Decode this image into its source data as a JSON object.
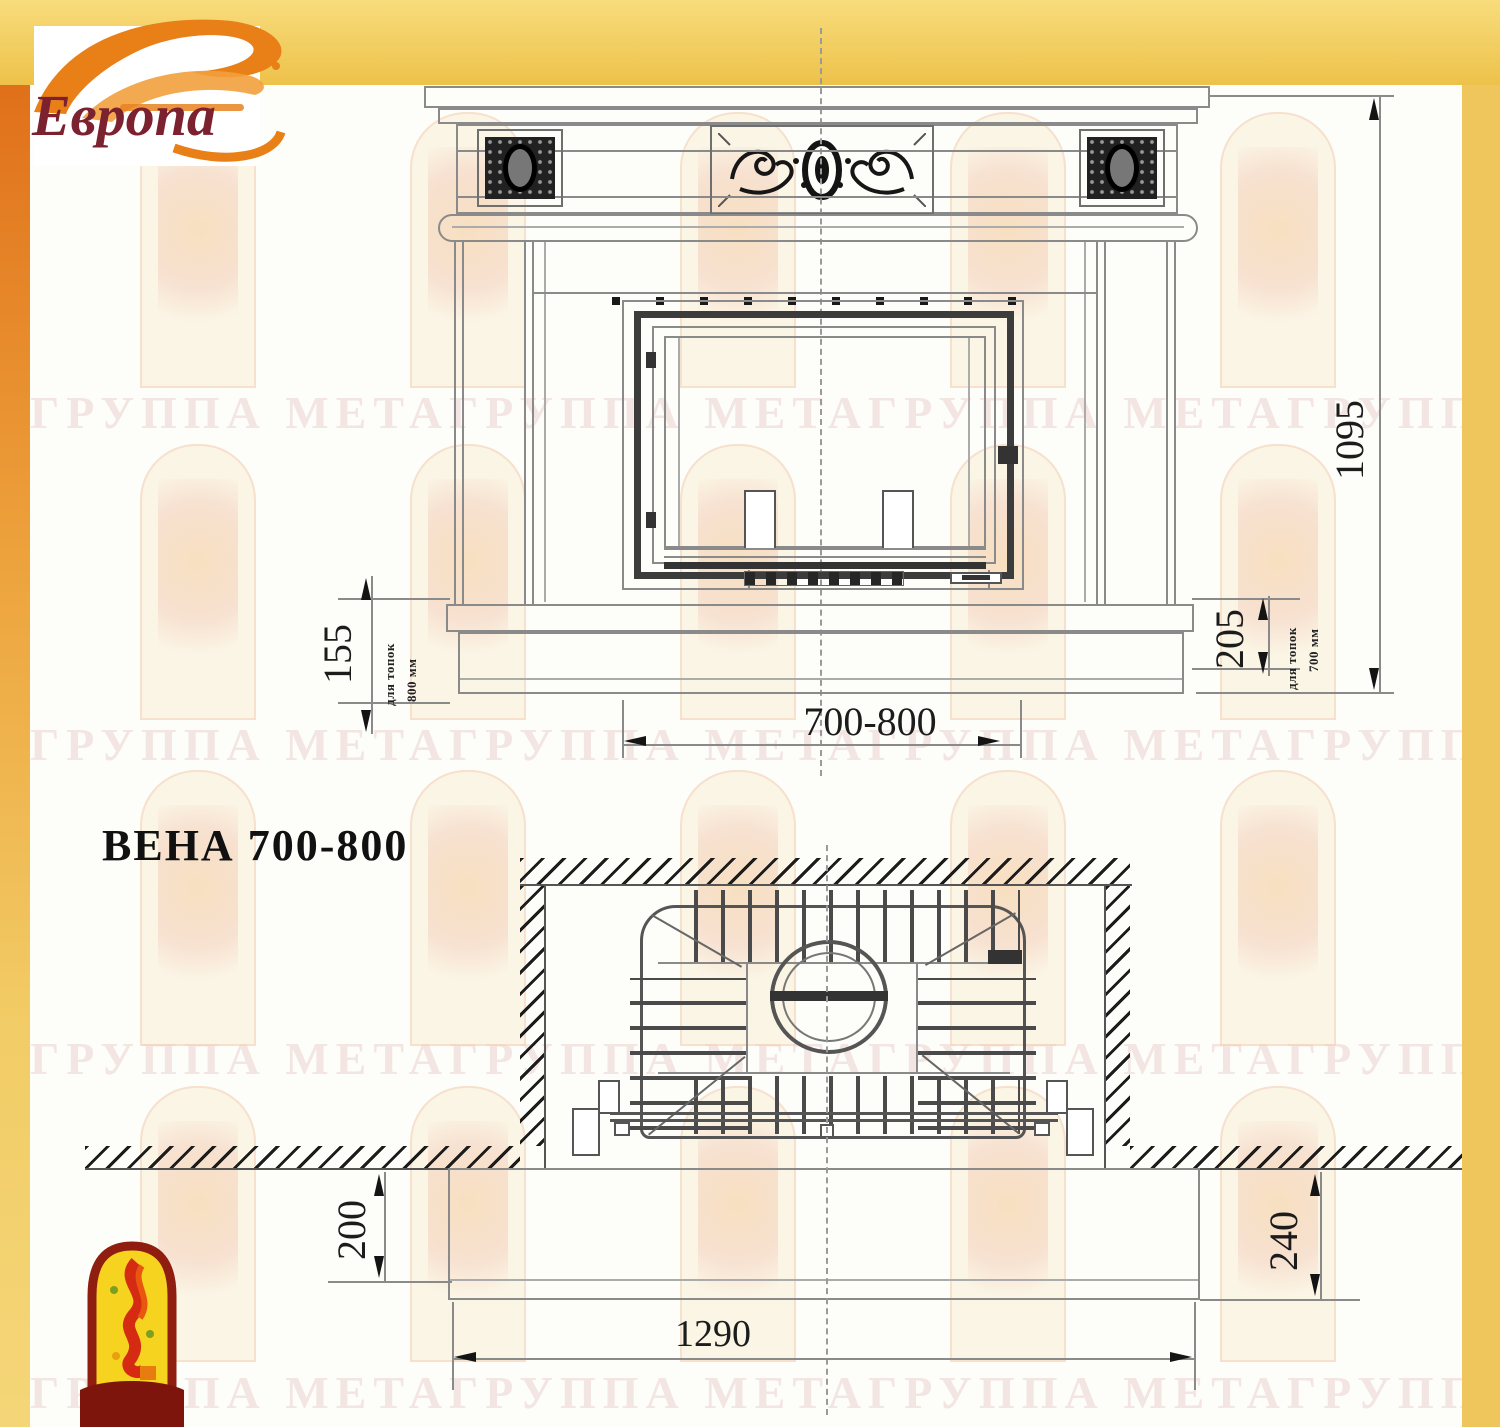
{
  "brand": {
    "logo_text": "Европа"
  },
  "title": "ВЕНА 700-800",
  "watermark_text": "ГРУППА МЕТАГРУППА МЕТАГРУППА МЕТАГРУППА МЕТАГРУППА МЕТА",
  "front_view": {
    "overall_height": "1095",
    "firebox_width_range": "700-800",
    "hearth_height_left": "155",
    "hearth_left_note_line1": "для топок",
    "hearth_left_note_line2": "800 мм",
    "hearth_height_right": "205",
    "hearth_right_note_line1": "для топок",
    "hearth_right_note_line2": "700 мм"
  },
  "plan_view": {
    "wall_offset_left": "200",
    "wall_offset_right": "240",
    "hearth_width": "1290"
  },
  "colors": {
    "frame_yellow": "#efc65c",
    "frame_orange": "#e0701a",
    "line_gray": "#8a8a8a",
    "ink": "#141414",
    "logo_red": "#7b2130",
    "flame_orange": "#e97f17"
  }
}
